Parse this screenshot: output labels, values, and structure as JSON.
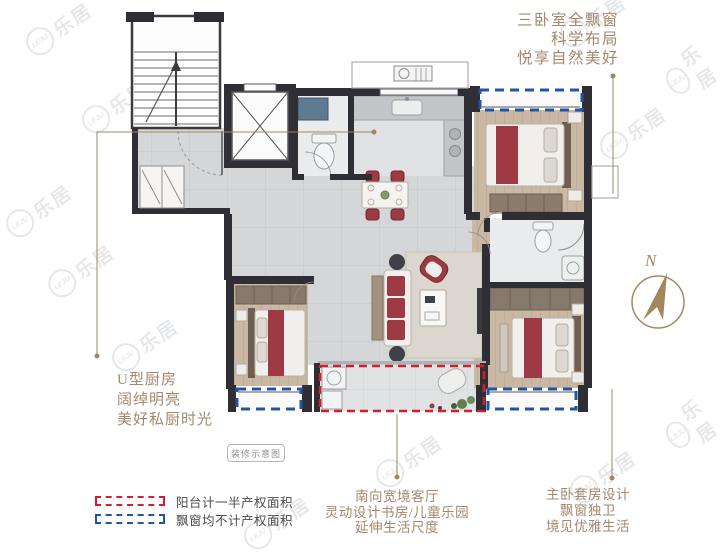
{
  "colors": {
    "annotation_tan": "#a3896d",
    "wall_dark": "#2e2e34",
    "balcony_red": "#cf2030",
    "baywindow_blue": "#2155a4",
    "accent_red": "#9e3a44",
    "compass_tan": "#a3885e"
  },
  "annotations": {
    "top_right": {
      "lines": [
        "三卧室全飘窗",
        "科学布局",
        "悦享自然美好"
      ]
    },
    "bottom_left": {
      "lines": [
        "U型厨房",
        "阔绰明亮",
        "美好私厨时光"
      ]
    },
    "bottom_center": {
      "lines": [
        "南向宽境客厅",
        "灵动设计书房/儿童乐园",
        "延伸生活尺度"
      ]
    },
    "bottom_right": {
      "lines": [
        "主卧套房设计",
        "飘窗独卫",
        "境见优雅生活"
      ]
    }
  },
  "legend": {
    "items": [
      {
        "label": "阳台计一半产权面积",
        "box_color": "#cf2030"
      },
      {
        "label": "飘窗均不计产权面积",
        "box_color": "#2155a4"
      }
    ]
  },
  "badge": {
    "label": "装修示意图"
  },
  "compass": {
    "label": "N"
  },
  "watermark": {
    "brand_cn": "乐居",
    "brand_en": "LEJU"
  }
}
